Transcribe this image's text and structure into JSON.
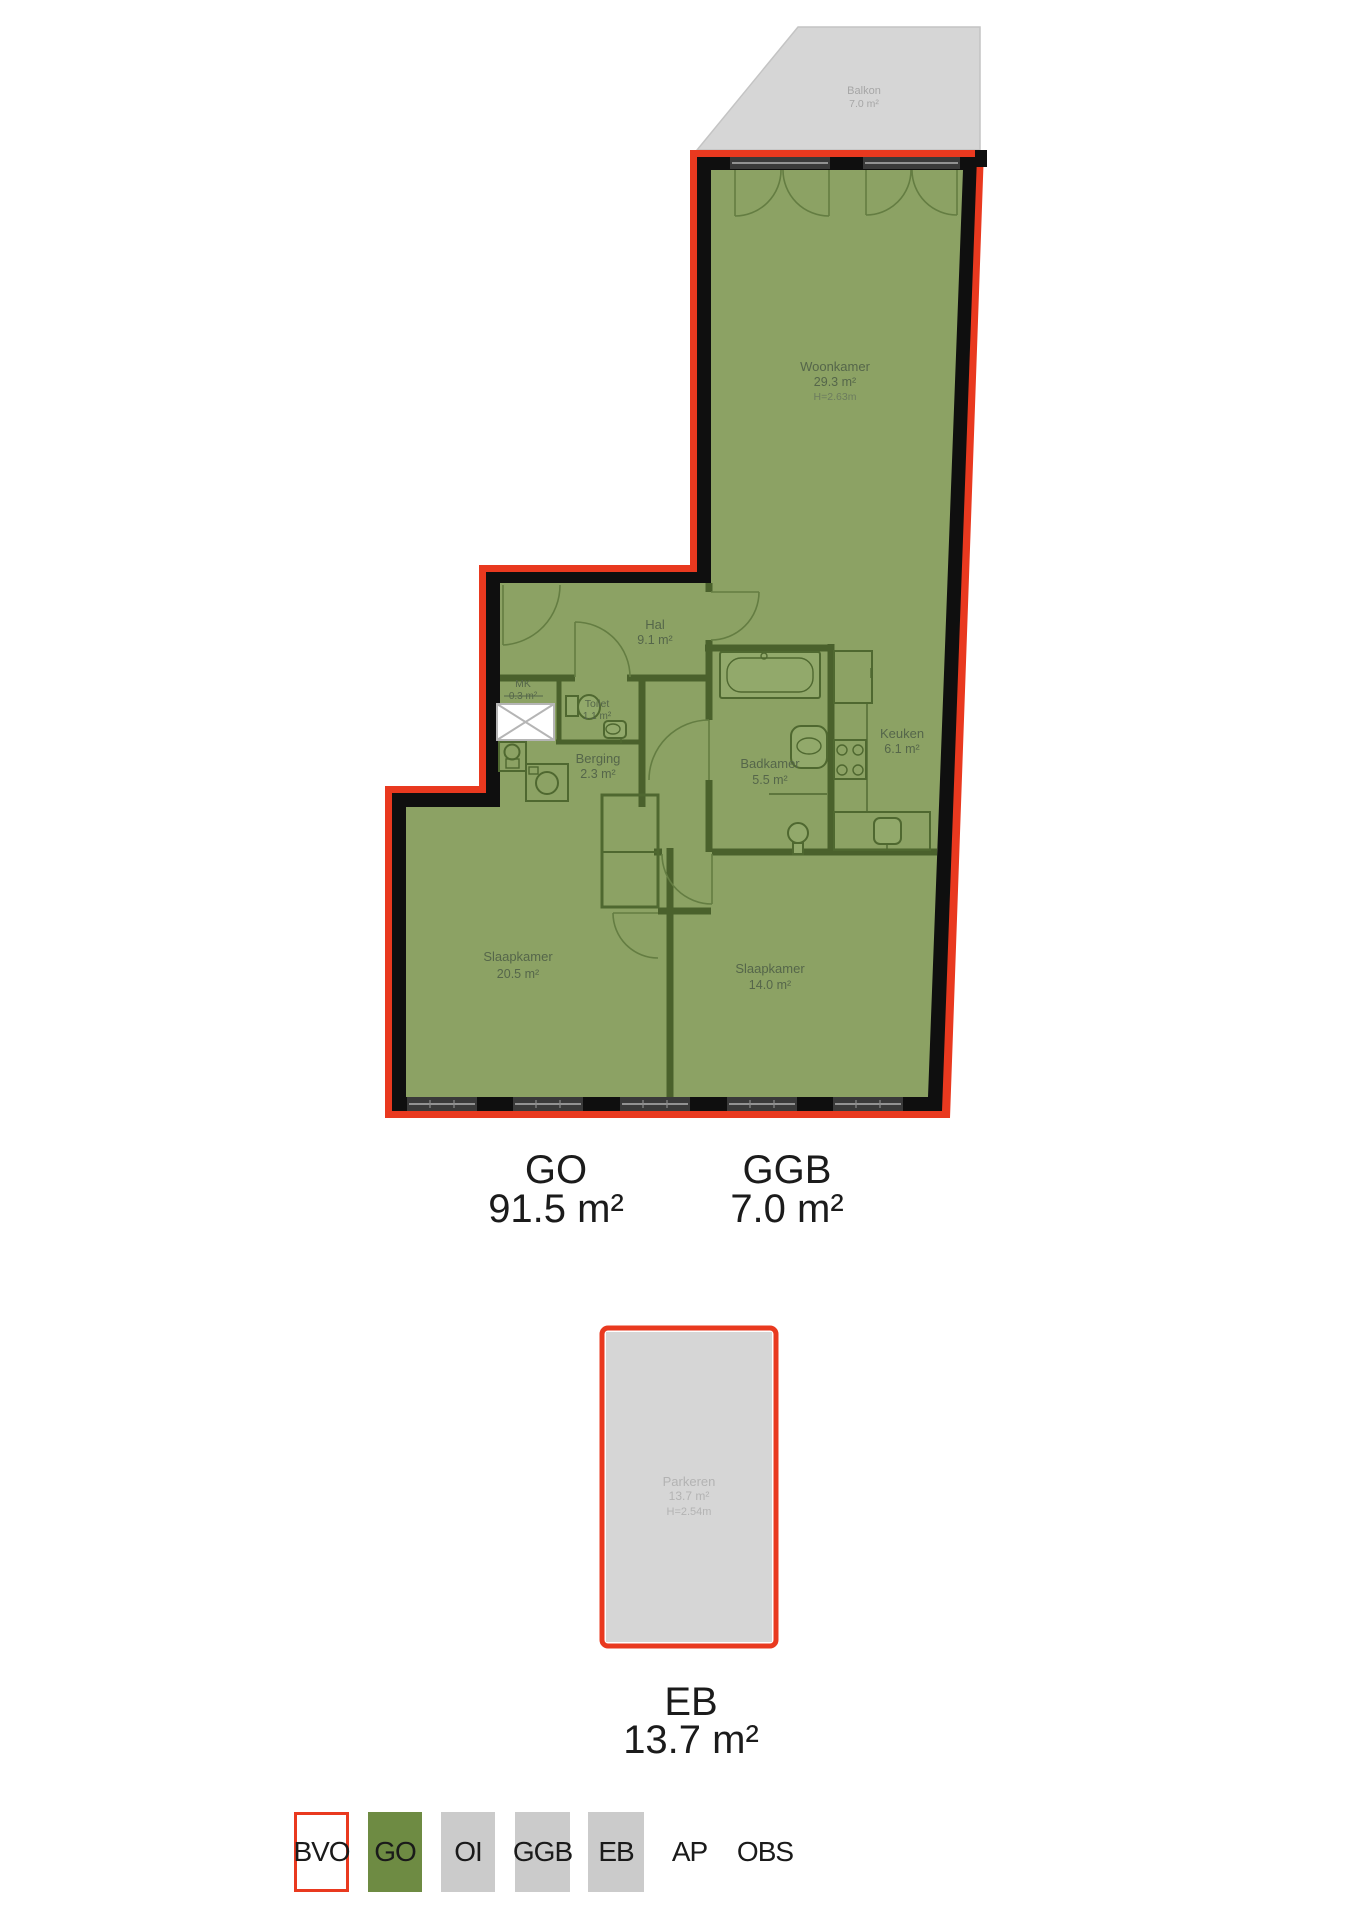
{
  "colors": {
    "bvo_red": "#e9391f",
    "go_floor_green": "#8ca264",
    "go_legend_green": "#6e8b43",
    "legend_gray": "#cbcbcb",
    "balcony_gray": "#d6d6d6",
    "parking_gray": "#d6d6d6",
    "wall_black": "#0f0f0f",
    "interior_wall_green": "#4a612c",
    "room_text_green": "#55664a",
    "gray_text": "#a6a6a6"
  },
  "balcony": {
    "name": "Balkon",
    "area": "7.0 m²"
  },
  "rooms": {
    "woonkamer": {
      "name": "Woonkamer",
      "area": "29.3 m²",
      "height": "H=2.63m"
    },
    "hal": {
      "name": "Hal",
      "area": "9.1 m²"
    },
    "mk": {
      "name": "MK",
      "area": "0.3 m²"
    },
    "toilet": {
      "name": "Toilet",
      "area": "1.1 m²"
    },
    "berging": {
      "name": "Berging",
      "area": "2.3 m²"
    },
    "badkamer": {
      "name": "Badkamer",
      "area": "5.5 m²"
    },
    "keuken": {
      "name": "Keuken",
      "area": "6.1 m²"
    },
    "slaapkamer_groot": {
      "name": "Slaapkamer",
      "area": "20.5 m²"
    },
    "slaapkamer_klein": {
      "name": "Slaapkamer",
      "area": "14.0 m²"
    }
  },
  "summary": {
    "go": {
      "code": "GO",
      "value": "91.5 m²"
    },
    "ggb": {
      "code": "GGB",
      "value": "7.0 m²"
    },
    "eb": {
      "code": "EB",
      "value": "13.7 m²"
    }
  },
  "parking": {
    "name": "Parkeren",
    "area": "13.7 m²",
    "height": "H=2.54m"
  },
  "legend": {
    "items": [
      {
        "code": "BVO",
        "variant": "outline-red"
      },
      {
        "code": "GO",
        "variant": "green"
      },
      {
        "code": "OI",
        "variant": "gray"
      },
      {
        "code": "GGB",
        "variant": "gray"
      },
      {
        "code": "EB",
        "variant": "gray"
      },
      {
        "code": "AP",
        "variant": "plain"
      },
      {
        "code": "OBS",
        "variant": "plain"
      }
    ]
  }
}
